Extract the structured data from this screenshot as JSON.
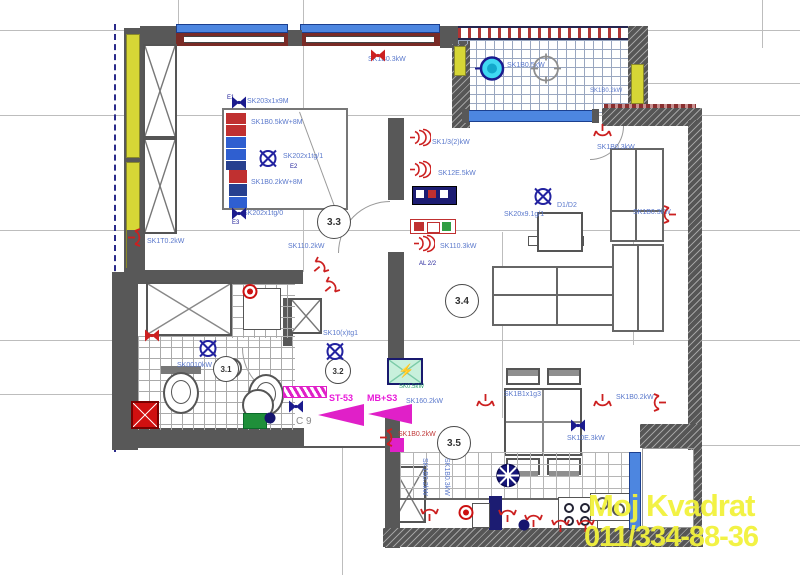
{
  "watermark": {
    "line1": "Moj Kvadrat",
    "line2": "011/334-88-36",
    "color": "#f2f23c"
  },
  "icons": {
    "lightning": "⚡"
  },
  "rooms": [
    {
      "num": "3.1",
      "x": 225,
      "y": 368,
      "r": 12,
      "fs": 8
    },
    {
      "num": "3.2",
      "x": 337,
      "y": 370,
      "r": 12,
      "fs": 8
    },
    {
      "num": "3.3",
      "x": 333,
      "y": 221,
      "r": 16,
      "fs": 10
    },
    {
      "num": "3.4",
      "x": 461,
      "y": 300,
      "r": 16,
      "fs": 10
    },
    {
      "num": "3.5",
      "x": 453,
      "y": 442,
      "r": 16,
      "fs": 10
    }
  ],
  "labels": [
    {
      "t": "E1",
      "x": 227,
      "y": 95,
      "c": "#22229a",
      "s": 6
    },
    {
      "t": "SK203x1x9M",
      "x": 247,
      "y": 98
    },
    {
      "t": "SK1B0.5kW+8M",
      "x": 251,
      "y": 119
    },
    {
      "t": "SK202x1tg/1",
      "x": 283,
      "y": 153
    },
    {
      "t": "E2",
      "x": 290,
      "y": 164,
      "c": "#22229a",
      "s": 6
    },
    {
      "t": "SK1B0.2kW+8M",
      "x": 251,
      "y": 179
    },
    {
      "t": "SK202x1tg/0",
      "x": 243,
      "y": 210
    },
    {
      "t": "E3",
      "x": 232,
      "y": 220,
      "c": "#22229a",
      "s": 6
    },
    {
      "t": "SK110.2kW",
      "x": 288,
      "y": 243
    },
    {
      "t": "SK1T0.2kW",
      "x": 147,
      "y": 238
    },
    {
      "t": "SK1B0.3kW",
      "x": 368,
      "y": 56
    },
    {
      "t": "SK1B0.5kW",
      "x": 507,
      "y": 62
    },
    {
      "t": "SK1B0.2kW",
      "x": 590,
      "y": 88,
      "s": 6
    },
    {
      "t": "SK1B0.3kW",
      "x": 597,
      "y": 144
    },
    {
      "t": "SK1B0.3kW",
      "x": 633,
      "y": 209
    },
    {
      "t": "SK1/3(2)kW",
      "x": 432,
      "y": 139
    },
    {
      "t": "SK12E.5kW",
      "x": 438,
      "y": 170
    },
    {
      "t": "SK110.3kW",
      "x": 440,
      "y": 243
    },
    {
      "t": "AL 2/2",
      "x": 419,
      "y": 261,
      "c": "#22229a",
      "s": 6
    },
    {
      "t": "SK20x9.1g/1",
      "x": 504,
      "y": 211
    },
    {
      "t": "D1/D2",
      "x": 557,
      "y": 202
    },
    {
      "t": "SK10(x)tg1",
      "x": 323,
      "y": 330
    },
    {
      "t": "SK0010kW",
      "x": 177,
      "y": 362
    },
    {
      "t": "SK160.2kW",
      "x": 406,
      "y": 398
    },
    {
      "t": "ST-53",
      "x": 329,
      "y": 394,
      "c": "#e818d8",
      "s": 9,
      "b": 1
    },
    {
      "t": "MB+S3",
      "x": 367,
      "y": 394,
      "c": "#e818d8",
      "s": 9,
      "b": 1
    },
    {
      "t": "SK0.5kW",
      "x": 399,
      "y": 384,
      "c": "#2aa06a",
      "s": 6
    },
    {
      "t": "SK1B0.2kW",
      "x": 398,
      "y": 431,
      "c": "#c03a3a"
    },
    {
      "t": "C 9",
      "x": 296,
      "y": 417,
      "c": "#8a8a8a",
      "s": 10
    },
    {
      "t": "SK1B1x1g3",
      "x": 504,
      "y": 391
    },
    {
      "t": "SK10E.3kW",
      "x": 567,
      "y": 435
    },
    {
      "t": "SK1B0.2kW",
      "x": 616,
      "y": 394
    },
    {
      "t": "SK1B0.2kW",
      "x": 428,
      "y": 458,
      "r": 90
    },
    {
      "t": "SK1B0.3kW",
      "x": 450,
      "y": 458,
      "r": 90
    }
  ],
  "symbols": [
    {
      "k": "junction-navy",
      "x": 239,
      "y": 105
    },
    {
      "k": "junction-navy",
      "x": 239,
      "y": 216
    },
    {
      "k": "junction-navy",
      "x": 296,
      "y": 409
    },
    {
      "k": "junction-navy",
      "x": 578,
      "y": 428
    },
    {
      "k": "junction-red",
      "x": 378,
      "y": 58
    },
    {
      "k": "junction-red",
      "x": 152,
      "y": 338
    },
    {
      "k": "ceiling-light",
      "x": 268,
      "y": 161
    },
    {
      "k": "ceiling-light",
      "x": 543,
      "y": 199
    },
    {
      "k": "ceiling-light",
      "x": 335,
      "y": 354
    },
    {
      "k": "ceiling-light",
      "x": 208,
      "y": 351
    },
    {
      "k": "fan-light",
      "x": 508,
      "y": 478
    },
    {
      "k": "terrace-lamp",
      "x": 490,
      "y": 71
    },
    {
      "k": "round-light",
      "x": 546,
      "y": 71
    },
    {
      "k": "downlight",
      "x": 524,
      "y": 527
    },
    {
      "k": "downlight",
      "x": 270,
      "y": 420
    },
    {
      "k": "valve",
      "x": 250,
      "y": 294
    },
    {
      "k": "valve",
      "x": 466,
      "y": 515
    },
    {
      "k": "wall-socket",
      "x": 136,
      "y": 240,
      "rot": 0
    },
    {
      "k": "wall-socket",
      "x": 322,
      "y": 268,
      "rot": -40
    },
    {
      "k": "wall-socket",
      "x": 333,
      "y": 288,
      "rot": -40
    },
    {
      "k": "triple-socket",
      "x": 420,
      "y": 140
    },
    {
      "k": "triple-socket",
      "x": 420,
      "y": 172
    },
    {
      "k": "triple-socket",
      "x": 424,
      "y": 246
    },
    {
      "k": "wall-socket",
      "x": 600,
      "y": 132,
      "rot": 90
    },
    {
      "k": "wall-socket",
      "x": 668,
      "y": 212,
      "rot": 180
    },
    {
      "k": "wall-socket",
      "x": 658,
      "y": 400,
      "rot": 180
    },
    {
      "k": "wall-socket",
      "x": 388,
      "y": 440,
      "rot": 0
    },
    {
      "k": "wall-socket",
      "x": 483,
      "y": 402,
      "rot": 90
    },
    {
      "k": "wall-socket",
      "x": 600,
      "y": 402,
      "rot": 90
    },
    {
      "k": "wall-socket",
      "x": 432,
      "y": 513,
      "rot": -90
    },
    {
      "k": "wall-socket",
      "x": 510,
      "y": 514,
      "rot": -90
    },
    {
      "k": "wall-socket",
      "x": 536,
      "y": 519,
      "rot": -90
    },
    {
      "k": "wall-socket",
      "x": 563,
      "y": 524,
      "rot": -90
    },
    {
      "k": "wall-socket",
      "x": 588,
      "y": 524,
      "rot": -90
    }
  ]
}
